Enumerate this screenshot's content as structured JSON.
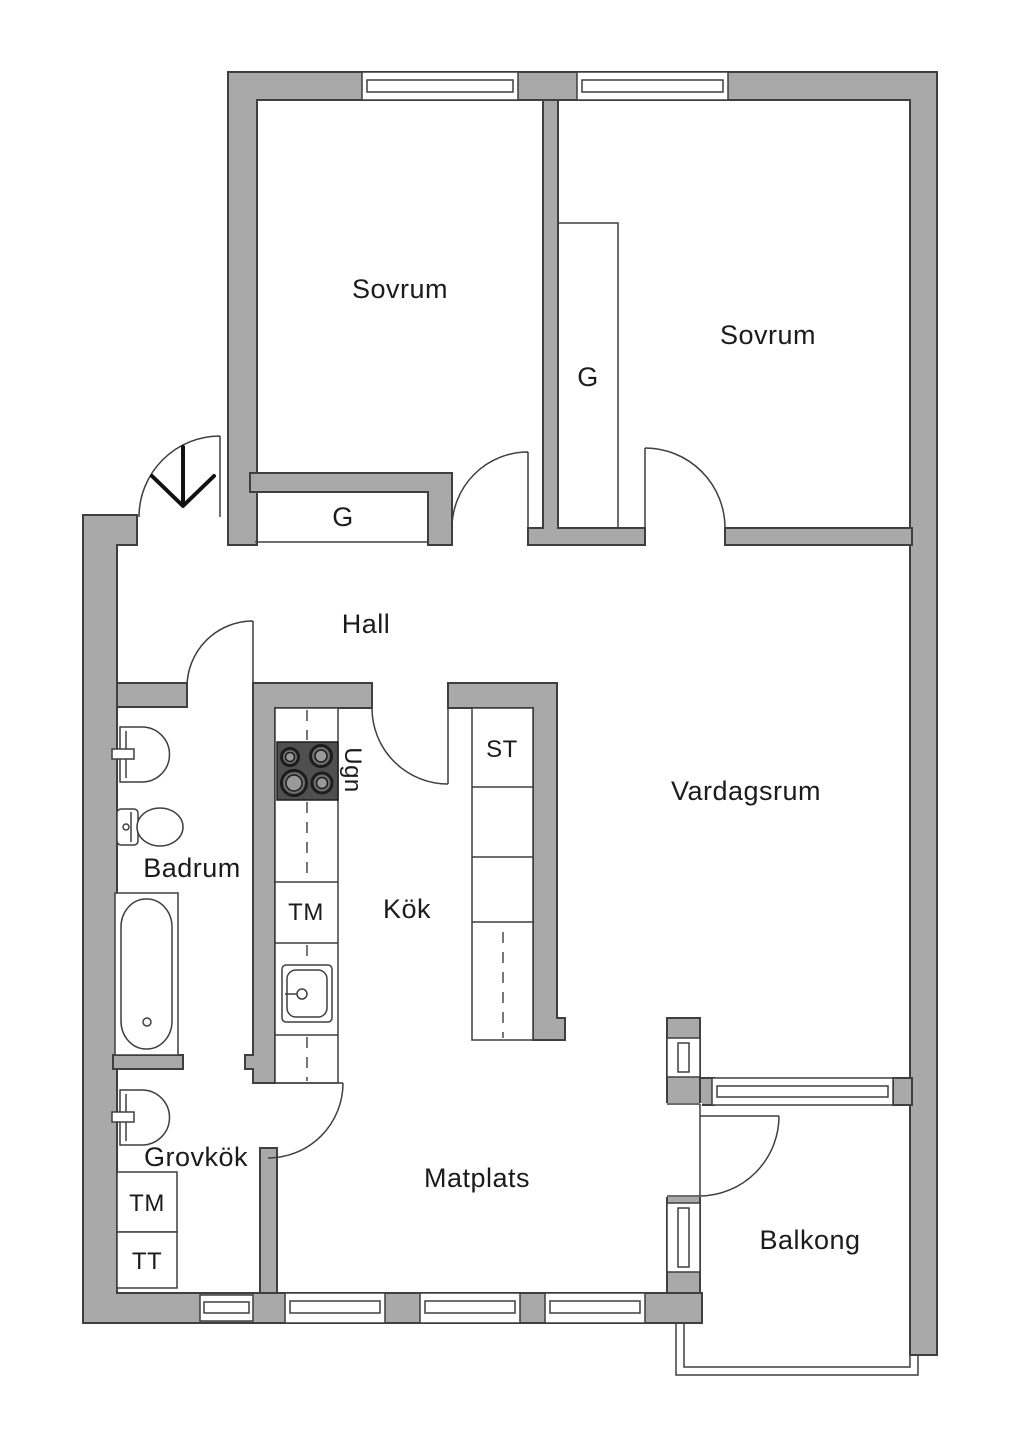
{
  "plan": {
    "labels": {
      "sovrum_left": "Sovrum",
      "sovrum_right": "Sovrum",
      "closet_right": "G",
      "closet_hall": "G",
      "hall": "Hall",
      "vardagsrum": "Vardagsrum",
      "st": "ST",
      "ugn": "Ugn",
      "badrum": "Badrum",
      "tm_kitchen": "TM",
      "kok": "Kök",
      "grovkok": "Grovkök",
      "matplats": "Matplats",
      "tm_grovkok": "TM",
      "tt": "TT",
      "balkong": "Balkong"
    },
    "colors": {
      "wall": "#a9a9a9",
      "outline": "#3f3f3f",
      "stove": "#4f4f4f",
      "text": "#1b1b1b",
      "background": "#ffffff"
    }
  }
}
